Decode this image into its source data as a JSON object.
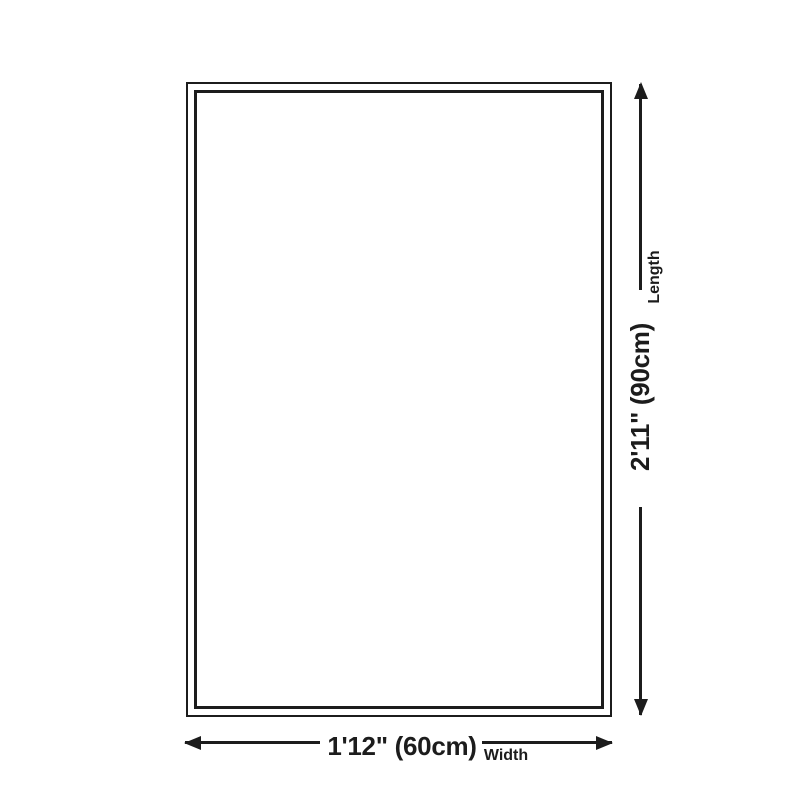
{
  "diagram": {
    "colors": {
      "background": "#ffffff",
      "line": "#1c1c1c"
    },
    "length": {
      "value": "2'11\" (90cm)",
      "label": "Length"
    },
    "width": {
      "value": "1'12\" (60cm)",
      "label": "Width"
    }
  }
}
